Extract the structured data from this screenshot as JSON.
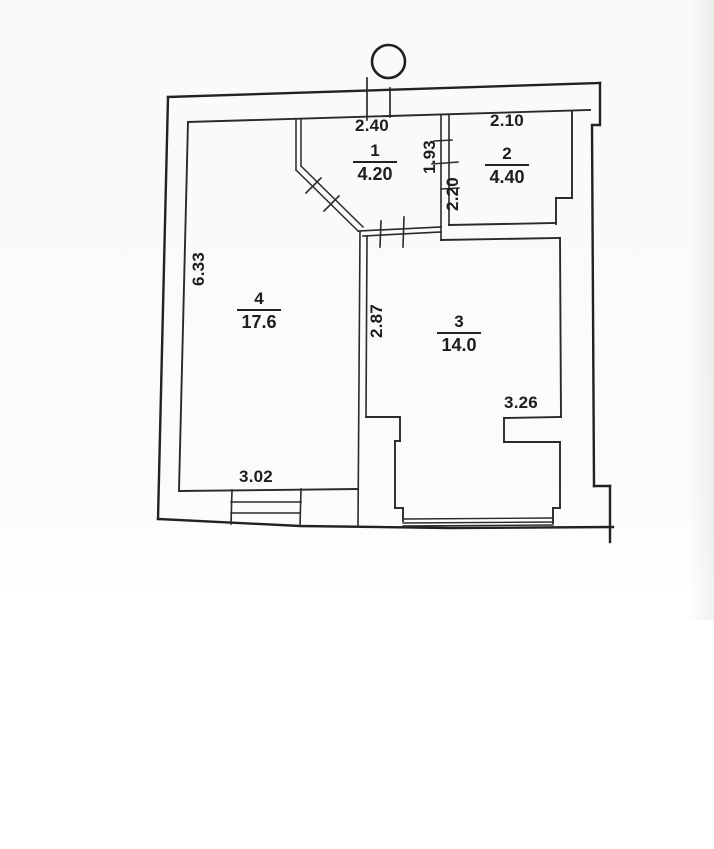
{
  "plan": {
    "type": "apartment-floor-plan-scan",
    "rooms": [
      {
        "number": "1",
        "area": "4.20"
      },
      {
        "number": "2",
        "area": "4.40"
      },
      {
        "number": "3",
        "area": "14.0"
      },
      {
        "number": "4",
        "area": "17.6"
      }
    ],
    "dimensions": {
      "room1_width": "2.40",
      "room2_width": "2.10",
      "partition_upper": "1.93",
      "partition_lower": "2.20",
      "room4_height": "6.33",
      "room3_depth": "2.87",
      "room3_width": "3.26",
      "room4_width": "3.02"
    },
    "colors": {
      "line": "#2a2a2a",
      "paper": "#fbfaf8"
    },
    "symbols": {
      "column": "circle",
      "duct": "double-vertical-lines",
      "window": "multi-line-band",
      "entrance_steps": "stepped-lines",
      "door_openings": "tick-marks"
    }
  }
}
